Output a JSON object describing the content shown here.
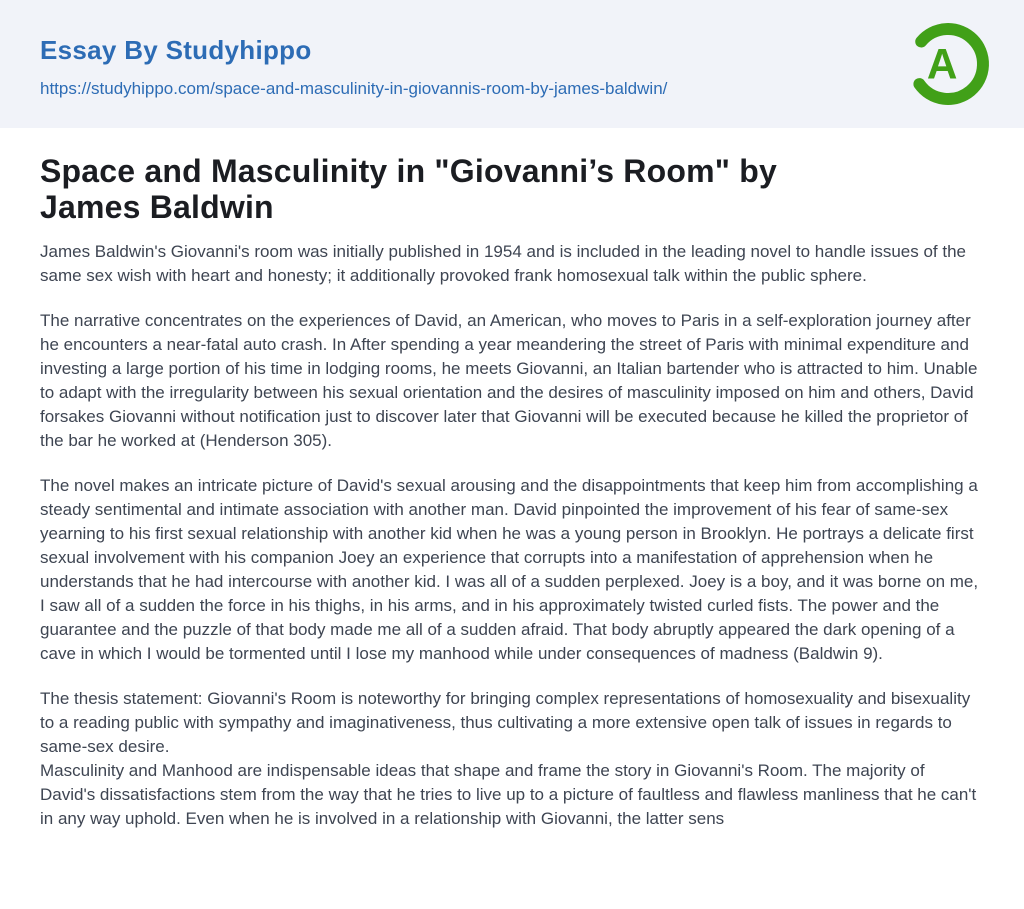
{
  "colors": {
    "header_background": "#f1f3f9",
    "brand_blue": "#2d6cb5",
    "logo_green": "#41a018",
    "title_color": "#1b1d22",
    "body_text_color": "#3e4552",
    "page_background": "#ffffff"
  },
  "header": {
    "brand": "Essay By Studyhippo",
    "url": "https://studyhippo.com/space-and-masculinity-in-giovannis-room-by-james-baldwin/",
    "logo": {
      "icon": "studyhippo-a-logo",
      "letter": "A",
      "color": "#41a018"
    }
  },
  "article": {
    "title": "Space and Masculinity in \"Giovanni’s Room\" by\nJames Baldwin",
    "paragraphs": [
      "James Baldwin's Giovanni's room was initially published in 1954 and is included in the leading novel to handle issues of the same sex wish with heart and honesty; it additionally provoked frank homosexual talk within the public sphere.",
      "The narrative concentrates on the experiences of David, an American, who moves to Paris in a self-exploration journey after he encounters a near-fatal auto crash. In After spending a year meandering the street of Paris with minimal expenditure and investing a large portion of his time in lodging rooms, he meets Giovanni, an Italian bartender who is attracted to him. Unable to adapt with the irregularity between his sexual orientation and the desires of masculinity imposed on him and others, David forsakes Giovanni without notification just to discover later that Giovanni will be executed because he killed the proprietor of the bar he worked at (Henderson 305).",
      "The novel makes an intricate picture of David's sexual arousing and the disappointments that keep him from accomplishing a steady sentimental and intimate association with another man. David pinpointed the improvement of his fear of same-sex yearning to his first sexual relationship with another kid when he was a young person in Brooklyn. He portrays a delicate first sexual involvement with his companion Joey an experience that corrupts into a manifestation of apprehension when he understands that he had intercourse with another kid. I was all of a sudden perplexed. Joey is a boy, and it was borne on me, I saw all of a sudden the force in his thighs, in his arms, and in his approximately twisted curled fists. The power and the guarantee and the puzzle of that body made me all of a sudden afraid. That body abruptly appeared the dark opening of a cave in which I would be tormented until I lose my manhood while under consequences of madness (Baldwin 9).",
      "The thesis statement: Giovanni's Room is noteworthy for bringing complex representations of homosexuality and bisexuality to a reading public with sympathy and imaginativeness, thus cultivating a more extensive open talk of issues in regards to same-sex desire.\nMasculinity and Manhood are indispensable ideas that shape and frame the story in Giovanni's Room. The majority of David's dissatisfactions stem from the way that he tries to live up to a picture of faultless and flawless manliness that he can't in any way uphold. Even when he is involved in a relationship with Giovanni, the latter sens"
    ]
  }
}
